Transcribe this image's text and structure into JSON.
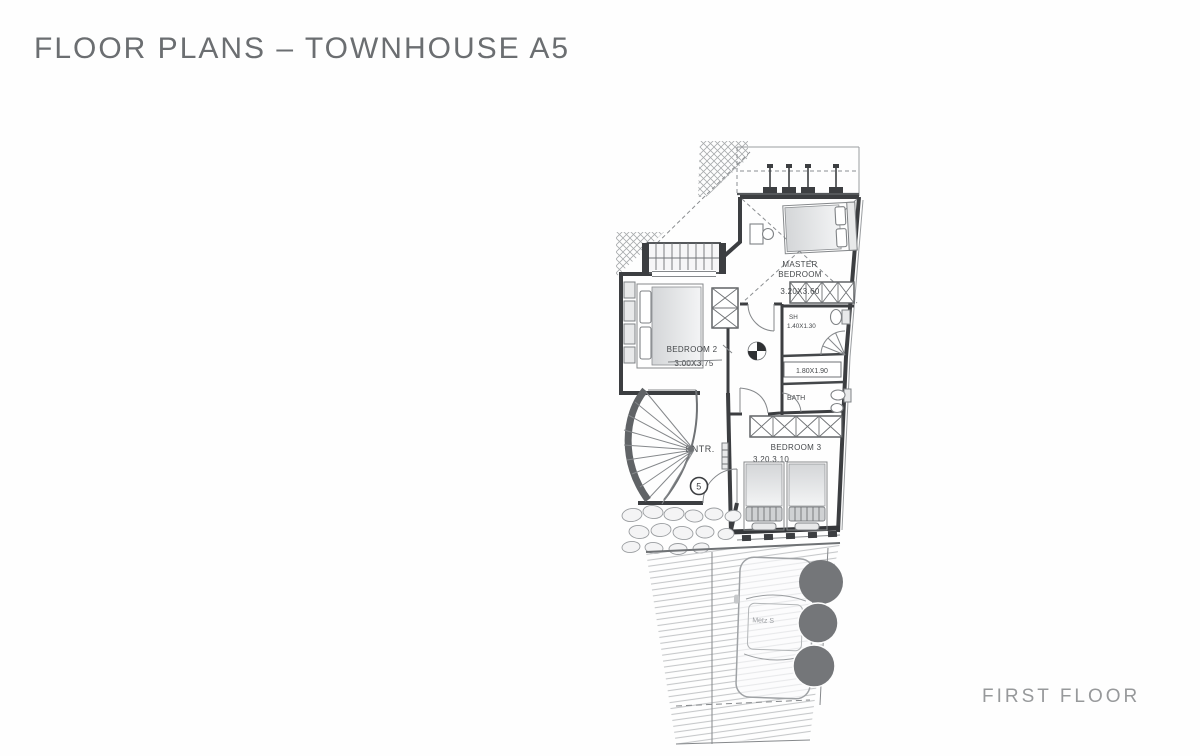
{
  "header": {
    "title": "FLOOR PLANS – TOWNHOUSE A5"
  },
  "footer": {
    "floor_label": "FIRST FLOOR"
  },
  "plan": {
    "master_bedroom": {
      "name_line1": "MASTER",
      "name_line2": "BEDROOM",
      "dims": "3.20X3.60"
    },
    "bedroom_2": {
      "name": "BEDROOM 2",
      "dims": "3.00X3.75"
    },
    "bedroom_3": {
      "name": "BEDROOM 3",
      "dims": "3.20.3.10"
    },
    "shower": {
      "name": "SH",
      "dims": "1.40X1.30"
    },
    "dressing": {
      "dims": "1.80X1.90"
    },
    "bath": {
      "name": "BATH"
    },
    "entrance": {
      "name": "ENTR.",
      "door_number": "5"
    },
    "driveway": {
      "car_label": "Metz S"
    },
    "colors": {
      "wall": "#3c3e41",
      "title_text": "#6b6e71",
      "footer_text": "#97999b",
      "tree": "#747679",
      "hatch_line": "#c6c8ca"
    }
  }
}
